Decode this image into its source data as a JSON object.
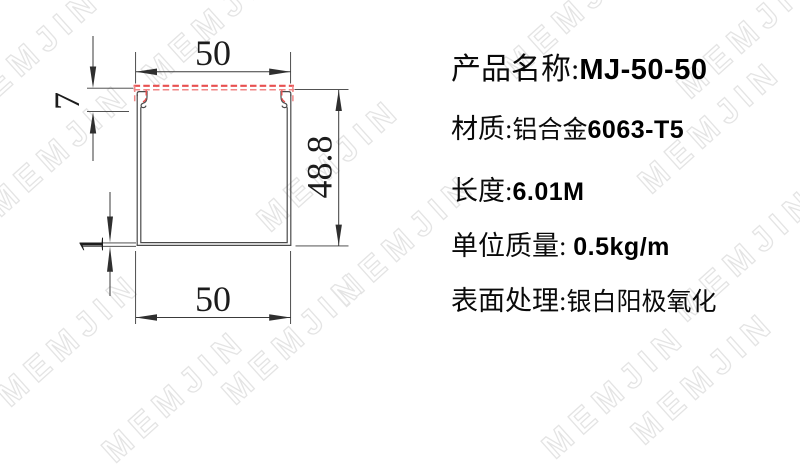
{
  "watermark": {
    "text": "MEMJIN",
    "outline_color": "#e4e4e4"
  },
  "drawing": {
    "dimensions": {
      "top_width": "50",
      "lid_depth": "7",
      "side_height": "48.8",
      "wall_thickness": "1",
      "bottom_width": "50"
    },
    "colors": {
      "profile_line": "#4a4a4a",
      "dimension_line": "#3a3a3a",
      "lid_dashed_red": "#e85050"
    }
  },
  "specs": {
    "rows": [
      {
        "label": "产品名称:",
        "cn": "",
        "en": "MJ-50-50"
      },
      {
        "label": "材质:",
        "cn": "铝合金",
        "en": "6063-T5"
      },
      {
        "label": "长度:",
        "cn": "",
        "en": "6.01M"
      },
      {
        "label": "单位质量: ",
        "cn": "",
        "en": "0.5kg/m"
      },
      {
        "label": "表面处理:",
        "cn": "银白阳极氧化",
        "en": ""
      }
    ]
  }
}
